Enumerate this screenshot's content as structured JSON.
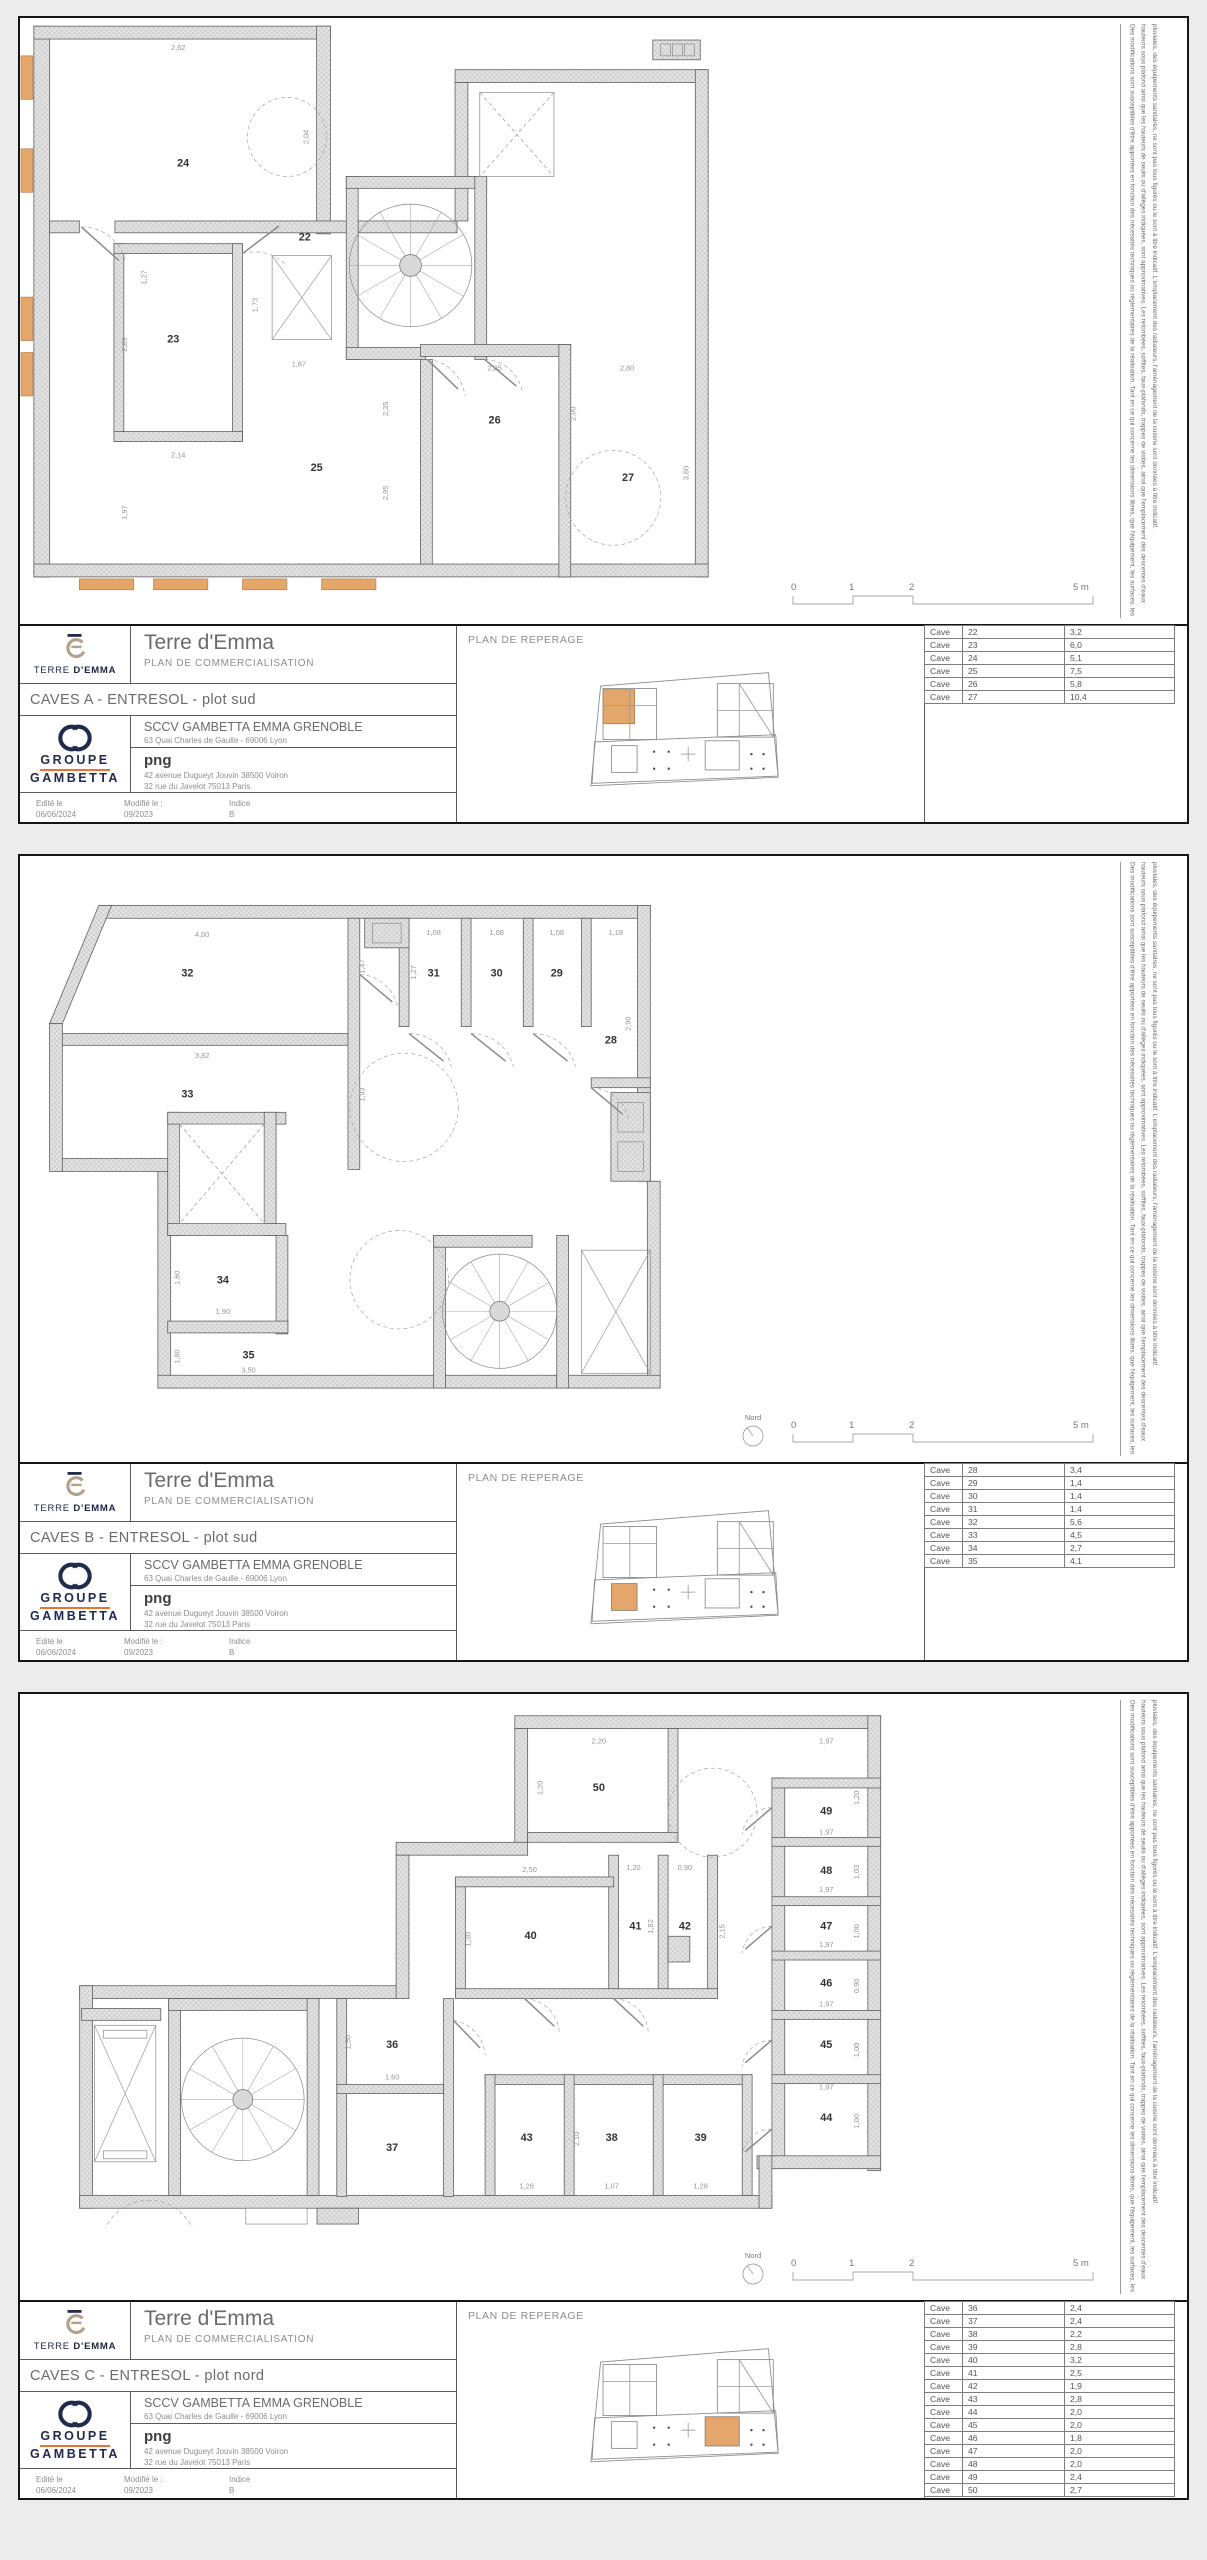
{
  "common": {
    "brand": {
      "logo_caption_regular": "TERRE ",
      "logo_caption_bold": "D'EMMA"
    },
    "title": "Terre d'Emma",
    "doc_type": "PLAN DE COMMERCIALISATION",
    "client": {
      "name": "SCCV GAMBETTA EMMA GRENOBLE",
      "address": "63 Quai Charles de Gaulle - 69006 Lyon"
    },
    "architect": {
      "name": "png",
      "address1": "42 avenue Dugueyt Jouvin 38500 Voiron",
      "address2": "32 rue du Javelot 75013 Paris"
    },
    "issue": {
      "edited_label": "Edité le",
      "edited_value": "06/06/2024",
      "modified_label": "Modifié le :",
      "modified_value": "09/2023",
      "indice_label": "Indice",
      "indice_value": "B"
    },
    "group_logo": {
      "line1": "GROUPE",
      "line2": "GAMBETTA"
    },
    "reperage_label": "PLAN DE REPERAGE",
    "scale": {
      "t0": "0",
      "t1": "1",
      "t2": "2",
      "t5": "5 m"
    },
    "north_label": "Nord",
    "disclaimer": {
      "l1": "Des modifications sont susceptibles d'être apportées en fonction des nécessités techniques ou réglementaires de la réalisation. Tant en ce qui concerne les dimensions libres, que l'équipement, les surfaces, les",
      "l2": "hauteurs sous plafond ainsi que les hauteurs de seuils ou d'allèges indiquées, sont approximatives. Les retombées, soffites, faux-plafonds, trappes de visites, ainsi que l'emplacement des descentes d'eaux",
      "l3": "pluviales, des équipements sanitaires, ne sont pas tous figurés ou le sont à titre indicatif. L'emplacement des radiateurs, l'aménagement de la cuisine sont données à titre indicatif."
    },
    "colors": {
      "accent_orange": "#e5a66b",
      "brand_navy": "#232b4d",
      "logo_tan": "#b3a289",
      "underline_orange": "#e0763a"
    }
  },
  "sheets": [
    {
      "plan_name": "CAVES A - ENTRESOL - plot sud",
      "reperage_highlight": "a",
      "table": [
        {
          "label": "Cave",
          "num": "22",
          "area": "3,2"
        },
        {
          "label": "Cave",
          "num": "23",
          "area": "6,0"
        },
        {
          "label": "Cave",
          "num": "24",
          "area": "5,1"
        },
        {
          "label": "Cave",
          "num": "25",
          "area": "7,5"
        },
        {
          "label": "Cave",
          "num": "26",
          "area": "5,8"
        },
        {
          "label": "Cave",
          "num": "27",
          "area": "10,4"
        }
      ],
      "rooms": [
        "24",
        "23",
        "22",
        "25",
        "26",
        "27"
      ],
      "dims": [
        "2,62",
        "2,04",
        "2,89",
        "2,14",
        "1,73",
        "1,87",
        "2,35",
        "2,95",
        "1,97",
        "1,27",
        "2,85",
        "2,00",
        "2,80",
        "3,60"
      ]
    },
    {
      "plan_name": "CAVES B - ENTRESOL - plot sud",
      "reperage_highlight": "b",
      "table": [
        {
          "label": "Cave",
          "num": "28",
          "area": "3,4"
        },
        {
          "label": "Cave",
          "num": "29",
          "area": "1,4"
        },
        {
          "label": "Cave",
          "num": "30",
          "area": "1,4"
        },
        {
          "label": "Cave",
          "num": "31",
          "area": "1,4"
        },
        {
          "label": "Cave",
          "num": "32",
          "area": "5,6"
        },
        {
          "label": "Cave",
          "num": "33",
          "area": "4,5"
        },
        {
          "label": "Cave",
          "num": "34",
          "area": "2,7"
        },
        {
          "label": "Cave",
          "num": "35",
          "area": "4,1"
        }
      ],
      "rooms": [
        "32",
        "33",
        "31",
        "30",
        "29",
        "28",
        "34",
        "35"
      ],
      "dims": [
        "4,00",
        "1,47",
        "3,82",
        "1,93",
        "1,08",
        "1,08",
        "1,08",
        "1,18",
        "2,90",
        "1,27",
        "1,60",
        "1,90",
        "1,80",
        "3,50"
      ]
    },
    {
      "plan_name": "CAVES C - ENTRESOL - plot nord",
      "reperage_highlight": "c",
      "table": [
        {
          "label": "Cave",
          "num": "36",
          "area": "2,4"
        },
        {
          "label": "Cave",
          "num": "37",
          "area": "2,4"
        },
        {
          "label": "Cave",
          "num": "38",
          "area": "2,2"
        },
        {
          "label": "Cave",
          "num": "39",
          "area": "2,8"
        },
        {
          "label": "Cave",
          "num": "40",
          "area": "3,2"
        },
        {
          "label": "Cave",
          "num": "41",
          "area": "2,5"
        },
        {
          "label": "Cave",
          "num": "42",
          "area": "1,9"
        },
        {
          "label": "Cave",
          "num": "43",
          "area": "2,8"
        },
        {
          "label": "Cave",
          "num": "44",
          "area": "2,0"
        },
        {
          "label": "Cave",
          "num": "45",
          "area": "2,0"
        },
        {
          "label": "Cave",
          "num": "46",
          "area": "1,8"
        },
        {
          "label": "Cave",
          "num": "47",
          "area": "2,0"
        },
        {
          "label": "Cave",
          "num": "48",
          "area": "2,0"
        },
        {
          "label": "Cave",
          "num": "49",
          "area": "2,4"
        },
        {
          "label": "Cave",
          "num": "50",
          "area": "2,7"
        }
      ],
      "rooms": [
        "50",
        "49",
        "48",
        "47",
        "46",
        "45",
        "44",
        "41",
        "42",
        "40",
        "36",
        "37",
        "43",
        "38",
        "39"
      ],
      "dims": [
        "2,20",
        "1,20",
        "1,97",
        "1,20",
        "2,50",
        "1,30",
        "1,20",
        "0,90",
        "1,82",
        "2,15",
        "1,97",
        "1,03",
        "1,97",
        "1,00",
        "1,97",
        "0,90",
        "1,97",
        "1,00",
        "1,97",
        "1,00",
        "1,50",
        "1,60",
        "1,26",
        "1,07",
        "1,28",
        "2,10"
      ]
    }
  ]
}
